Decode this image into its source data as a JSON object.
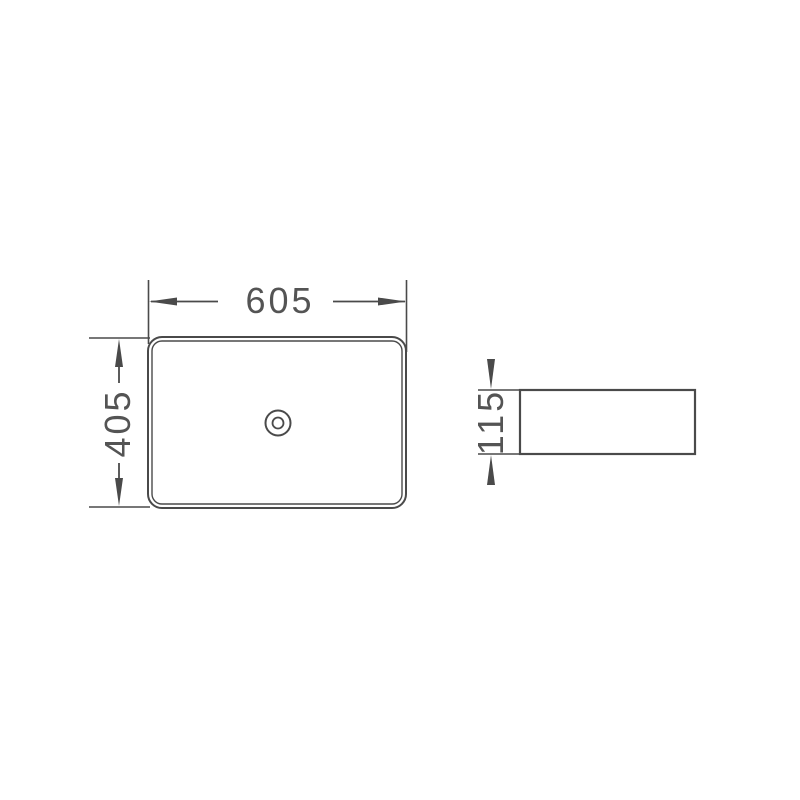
{
  "dimensions": {
    "top_width": "605",
    "top_depth": "405",
    "side_height": "115"
  },
  "colors": {
    "line": "#4a4a4a",
    "text": "#545454",
    "background": "#ffffff"
  }
}
